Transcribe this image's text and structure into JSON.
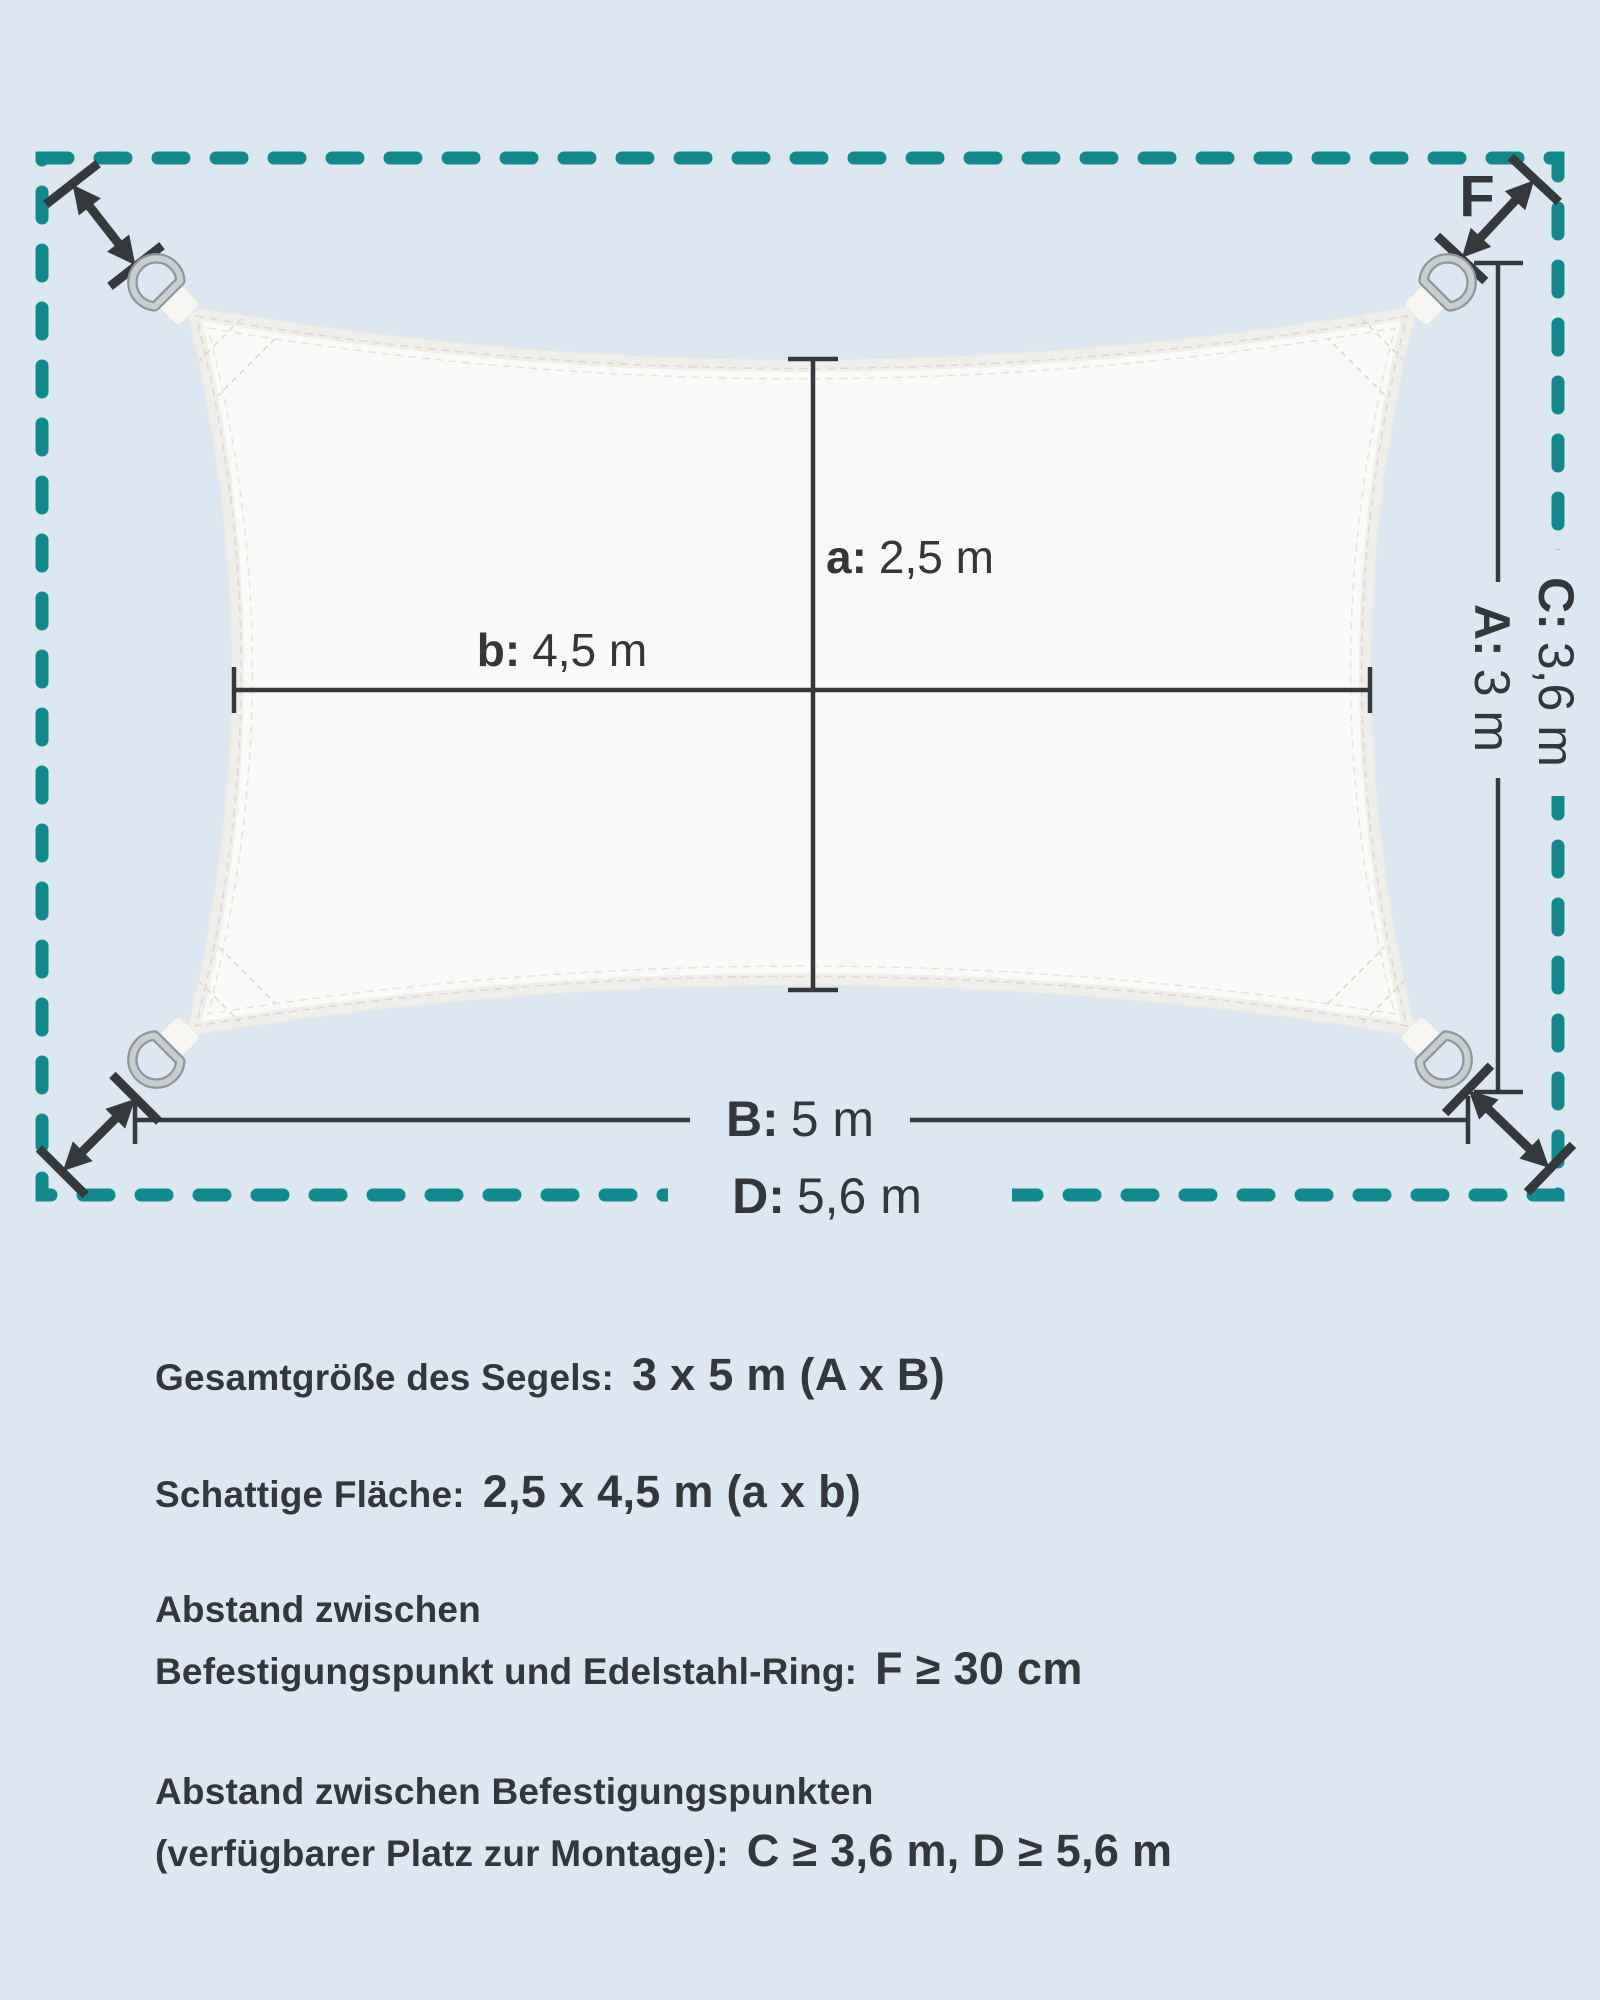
{
  "colors": {
    "background": "#dce7f1",
    "border_teal": "#12898d",
    "line_dark": "#35393c",
    "sail_white": "#f9f9f7",
    "ring_silver": "#c9ced1"
  },
  "diagram": {
    "f_label": "F",
    "labels": {
      "a": {
        "prefix": "a:",
        "value": "2,5 m"
      },
      "b": {
        "prefix": "b:",
        "value": "4,5 m"
      },
      "A": {
        "prefix": "A:",
        "value": "3 m"
      },
      "B": {
        "prefix": "B:",
        "value": "5 m"
      },
      "C": {
        "prefix": "C:",
        "value": "3,6 m"
      },
      "D": {
        "prefix": "D:",
        "value": "5,6 m"
      }
    }
  },
  "specs": {
    "row1": {
      "label": "Gesamtgröße des Segels:",
      "value": "3 x 5 m (A x B)"
    },
    "row2": {
      "label": "Schattige Fläche:",
      "value": "2,5 x 4,5 m (a x b)"
    },
    "row3": {
      "label_line1": "Abstand zwischen",
      "label_line2": "Befestigungspunkt und Edelstahl-Ring:",
      "value": "F ≥ 30 cm"
    },
    "row4": {
      "label_line1": "Abstand zwischen Befestigungspunkten",
      "label_line2": "(verfügbarer Platz zur Montage):",
      "value": "C ≥ 3,6 m, D ≥ 5,6 m"
    }
  }
}
